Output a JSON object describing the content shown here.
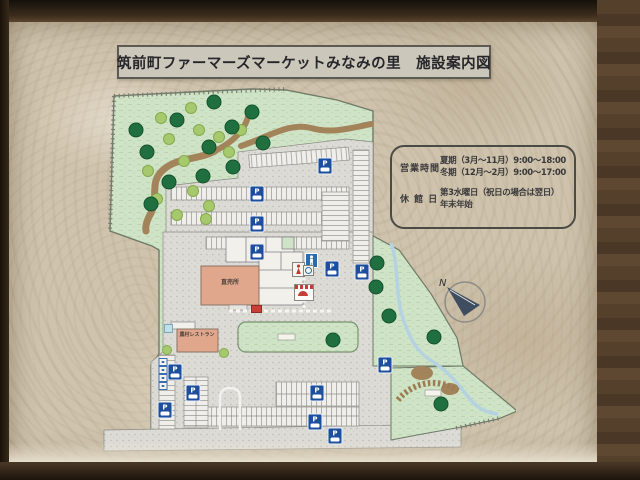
{
  "sign": {
    "title": "筑前町ファーマーズマーケットみなみの里　施設案内図",
    "info_box": {
      "hours_label": "営業時間",
      "hours_lines": [
        "夏期（3月～11月）9:00～18:00",
        "冬期（12月～2月）9:00～17:00"
      ],
      "closed_label": "休 館 日",
      "closed_lines": [
        "第3水曜日（祝日の場合は翌日）",
        "年末年始"
      ]
    },
    "compass_label": "N"
  },
  "map": {
    "buildings": {
      "main_shop_label": "直売所",
      "restaurant_label": "農村レストラン"
    },
    "parking_icon_letter": "P",
    "parking_icons": [
      [
        325,
        166
      ],
      [
        257,
        194
      ],
      [
        257,
        224
      ],
      [
        257,
        252
      ],
      [
        332,
        269
      ],
      [
        362,
        272
      ],
      [
        175,
        372
      ],
      [
        193,
        393
      ],
      [
        165,
        410
      ],
      [
        317,
        393
      ],
      [
        315,
        422
      ],
      [
        385,
        365
      ],
      [
        335,
        436
      ]
    ],
    "accessible_spots": [
      [
        163,
        362
      ],
      [
        163,
        370
      ],
      [
        163,
        378
      ],
      [
        163,
        386
      ]
    ],
    "trees_dark": [
      [
        135,
        130
      ],
      [
        176,
        120
      ],
      [
        213,
        102
      ],
      [
        231,
        127
      ],
      [
        146,
        152
      ],
      [
        208,
        147
      ],
      [
        232,
        167
      ],
      [
        168,
        182
      ],
      [
        202,
        176
      ],
      [
        150,
        204
      ],
      [
        251,
        112
      ],
      [
        262,
        143
      ],
      [
        376,
        263
      ],
      [
        375,
        287
      ],
      [
        388,
        316
      ],
      [
        433,
        337
      ],
      [
        440,
        404
      ],
      [
        332,
        340
      ]
    ],
    "trees_light": [
      [
        160,
        118
      ],
      [
        190,
        108
      ],
      [
        198,
        130
      ],
      [
        168,
        139
      ],
      [
        147,
        171
      ],
      [
        183,
        161
      ],
      [
        218,
        137
      ],
      [
        192,
        191
      ],
      [
        156,
        199
      ],
      [
        208,
        206
      ],
      [
        176,
        215
      ],
      [
        228,
        152
      ],
      [
        240,
        130
      ],
      [
        205,
        219
      ]
    ],
    "colors": {
      "site_green": "#cfe4c6",
      "parking_gray": "#dcdbd6",
      "building_salmon": "#e0a78c",
      "tree_dark": "#1f6f3f",
      "tree_dark_stroke": "#14522c",
      "tree_light": "#a6c96e",
      "tree_light_stroke": "#86a94f",
      "parking_blue": "#1d4f9e",
      "path_brown": "#a3845a",
      "stream_blue": "#b5d2e3"
    }
  }
}
